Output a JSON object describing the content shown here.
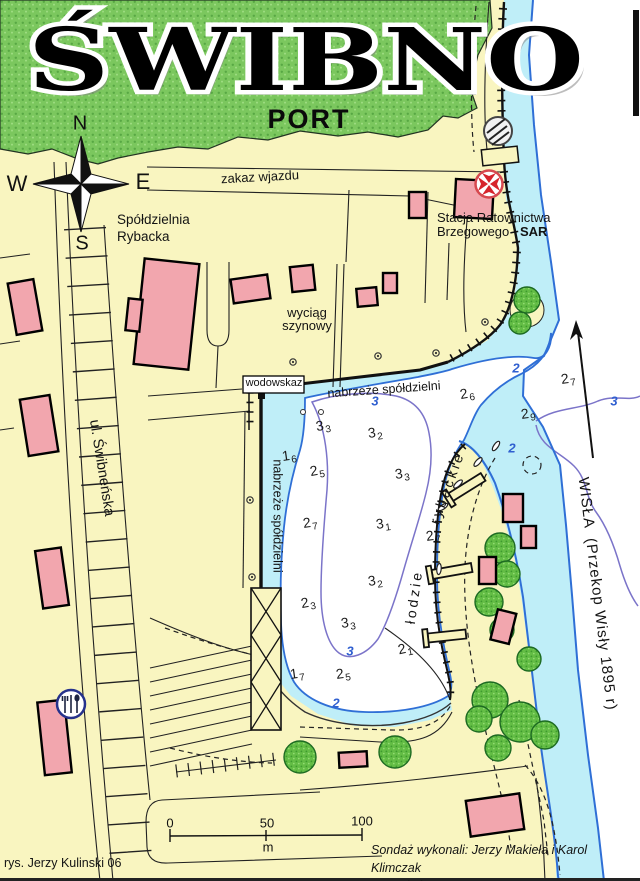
{
  "header": {
    "title": "ŚWIBNO",
    "subtitle": "PORT"
  },
  "compass": {
    "north": "N",
    "west": "W",
    "east": "E",
    "south": "S"
  },
  "scale_bar": {
    "tick_0": "0",
    "tick_50": "50",
    "tick_100": "100",
    "unit": "m"
  },
  "credits": {
    "author": "rys. Jerzy Kulinski 06",
    "survey_line1": "Sondaż wykonali: Jerzy Makieła i Karol Klimczak",
    "survey_line2": "Wrzesień 2006"
  },
  "colors": {
    "land": "#f9f5c0",
    "shallow_water": "#bfeef8",
    "river": "#ffffff",
    "building": "#f2a6ae",
    "grass": "#7bc75e",
    "shoreline_blue": "#2f6fd6",
    "contour_purple": "#7b74c9",
    "sar_red": "#d6242c"
  },
  "icons": {
    "compass": "compass-rose",
    "sar": "maltese-cross-in-circle",
    "ferry": "cable-ferry-circle",
    "restaurant": "cutlery-in-circle",
    "river_flow": "north-arrow",
    "mooring": "bollard-dot",
    "boat": "small-boat-ellipse"
  },
  "map": {
    "labels": [
      {
        "id": "zakaz-wjazdu",
        "text": "zakaz wjazdu",
        "x": 260,
        "y": 177,
        "rot": -3,
        "size": 13,
        "anchor": "c"
      },
      {
        "id": "spoldzielnia-line1",
        "text": "Spółdzielnia",
        "x": 117,
        "y": 213,
        "size": 13.5,
        "anchor": "lt"
      },
      {
        "id": "spoldzielnia-line2",
        "text": "Rybacka",
        "x": 117,
        "y": 230,
        "size": 13.5,
        "anchor": "lt"
      },
      {
        "id": "sar-line1",
        "text": "Stacja Ratownictwa",
        "x": 437,
        "y": 211,
        "size": 13,
        "anchor": "lt"
      },
      {
        "id": "sar-line2",
        "text": "Brzegowego",
        "x": 437,
        "y": 225,
        "size": 13,
        "anchor": "lt"
      },
      {
        "id": "sar-bold",
        "text": "SAR",
        "x": 520,
        "y": 225,
        "size": 13,
        "weight": 700,
        "anchor": "lt"
      },
      {
        "id": "wyciag-line1",
        "text": "wyciąg",
        "x": 307,
        "y": 313,
        "size": 13,
        "anchor": "c"
      },
      {
        "id": "wyciag-line2",
        "text": "szynowy",
        "x": 307,
        "y": 326,
        "size": 13,
        "anchor": "c"
      },
      {
        "id": "wodowskaz",
        "text": "wodowskaz",
        "x": 274,
        "y": 384,
        "size": 11,
        "anchor": "c"
      },
      {
        "id": "nabrzeze-north",
        "text": "nabrzeże spółdzielni",
        "x": 384,
        "y": 390,
        "rot": -4,
        "size": 12.5,
        "anchor": "c"
      },
      {
        "id": "nabrzeze-west",
        "text": "nabrzeże spółdzielni",
        "x": 277,
        "y": 516,
        "rot": 90,
        "size": 12.5,
        "anchor": "c"
      },
      {
        "id": "ulica-swibnenska",
        "text": "ul. Świbneńska",
        "x": 101,
        "y": 468,
        "rot": 81,
        "size": 14.5,
        "anchor": "c"
      },
      {
        "id": "lodzie",
        "text": "łodzie",
        "x": 414,
        "y": 597,
        "rot": -82,
        "size": 14,
        "ls": 3,
        "anchor": "c"
      },
      {
        "id": "rybackie",
        "text": "rybackie",
        "x": 447,
        "y": 488,
        "rot": -70,
        "size": 14,
        "ls": 3,
        "anchor": "c"
      },
      {
        "id": "wisla",
        "text": "WISŁA  (Przekop Wisły 1895 r)",
        "x": 597,
        "y": 594,
        "rot": 83,
        "size": 15,
        "ls": 1,
        "anchor": "c"
      }
    ],
    "depths": [
      {
        "v": "3",
        "s": "3",
        "x": 323,
        "y": 425,
        "rot": -10
      },
      {
        "v": "3",
        "s": "2",
        "x": 375,
        "y": 432,
        "rot": -8
      },
      {
        "v": "1",
        "s": "6",
        "x": 289,
        "y": 455,
        "rot": -8
      },
      {
        "v": "2",
        "s": "5",
        "x": 317,
        "y": 470,
        "rot": -10
      },
      {
        "v": "3",
        "s": "3",
        "x": 402,
        "y": 473,
        "rot": -8
      },
      {
        "v": "2",
        "s": "7",
        "x": 310,
        "y": 522,
        "rot": -8
      },
      {
        "v": "3",
        "s": "1",
        "x": 383,
        "y": 523,
        "rot": -8
      },
      {
        "v": "3",
        "s": "2",
        "x": 375,
        "y": 580,
        "rot": -8
      },
      {
        "v": "2",
        "s": "3",
        "x": 308,
        "y": 602,
        "rot": -10
      },
      {
        "v": "3",
        "s": "3",
        "x": 348,
        "y": 622,
        "rot": -8
      },
      {
        "v": "2",
        "s": "1",
        "x": 405,
        "y": 648,
        "rot": -12
      },
      {
        "v": "1",
        "s": "7",
        "x": 297,
        "y": 673,
        "rot": -8
      },
      {
        "v": "2",
        "s": "5",
        "x": 343,
        "y": 673,
        "rot": -8
      },
      {
        "v": "2",
        "s": "6",
        "x": 467,
        "y": 393,
        "rot": -10
      },
      {
        "v": "2",
        "s": "9",
        "x": 528,
        "y": 413,
        "rot": -8
      },
      {
        "v": "2",
        "s": "7",
        "x": 568,
        "y": 378,
        "rot": -8
      },
      {
        "v": "2",
        "s": "7",
        "x": 433,
        "y": 535,
        "rot": -8
      }
    ],
    "contour_labels": [
      {
        "v": "3",
        "x": 375,
        "y": 401
      },
      {
        "v": "3",
        "x": 350,
        "y": 651
      },
      {
        "v": "2",
        "x": 336,
        "y": 703
      },
      {
        "v": "2",
        "x": 516,
        "y": 368
      },
      {
        "v": "2",
        "x": 512,
        "y": 448
      },
      {
        "v": "3",
        "x": 614,
        "y": 401
      }
    ]
  }
}
